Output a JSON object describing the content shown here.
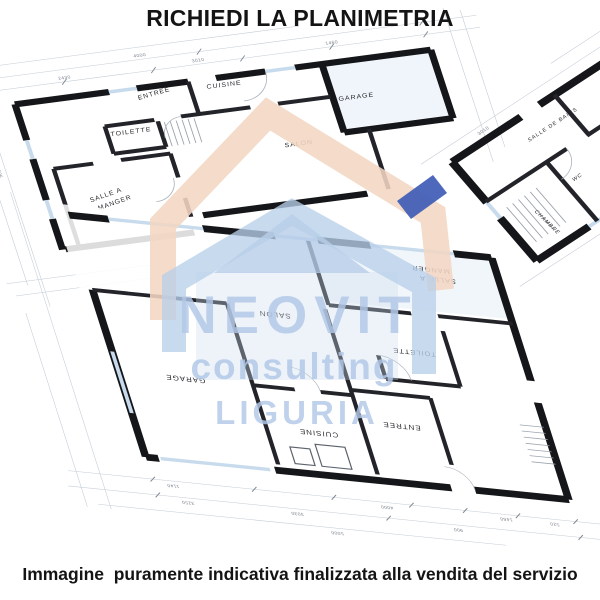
{
  "title": "RICHIEDI LA PLANIMETRIA",
  "caption": "Immagine  puramente indicativa finalizzata alla vendita del servizio",
  "watermark": {
    "brand": "NEOVIT",
    "tagline": "consulting",
    "region": "LIGURIA",
    "colors": {
      "house_outline": "#f3d6c3",
      "house_fill": "#b9cfe9",
      "chimney": "#3f5cb5",
      "text": "#b2c8e7"
    }
  },
  "plans": {
    "top_left": {
      "rooms": [
        {
          "label": "ENTREE"
        },
        {
          "label": "CUISINE"
        },
        {
          "label": "TOILETTE"
        },
        {
          "label": "SALLE A MANGER",
          "lines": [
            "SALLE A",
            "MANGER"
          ]
        },
        {
          "label": "SALON"
        },
        {
          "label": "GARAGE"
        }
      ]
    },
    "top_right": {
      "rooms": [
        {
          "label": "SALLE DE BAINS"
        },
        {
          "label": "CHAMBRE"
        },
        {
          "label": "WC"
        }
      ]
    },
    "bottom": {
      "rooms": [
        {
          "label": "GARAGE"
        },
        {
          "label": "SALON"
        },
        {
          "label": "CUISINE"
        },
        {
          "label": "ENTREE"
        },
        {
          "label": "TOILETTE"
        },
        {
          "label": "SALLE A MANGER",
          "lines": [
            "SALLE A",
            "MANGER"
          ]
        }
      ]
    }
  },
  "dimensions": {
    "values": [
      "4000",
      "3030",
      "1460",
      "900",
      "520",
      "5000",
      "1140",
      "3250",
      "2430",
      "3010"
    ]
  }
}
